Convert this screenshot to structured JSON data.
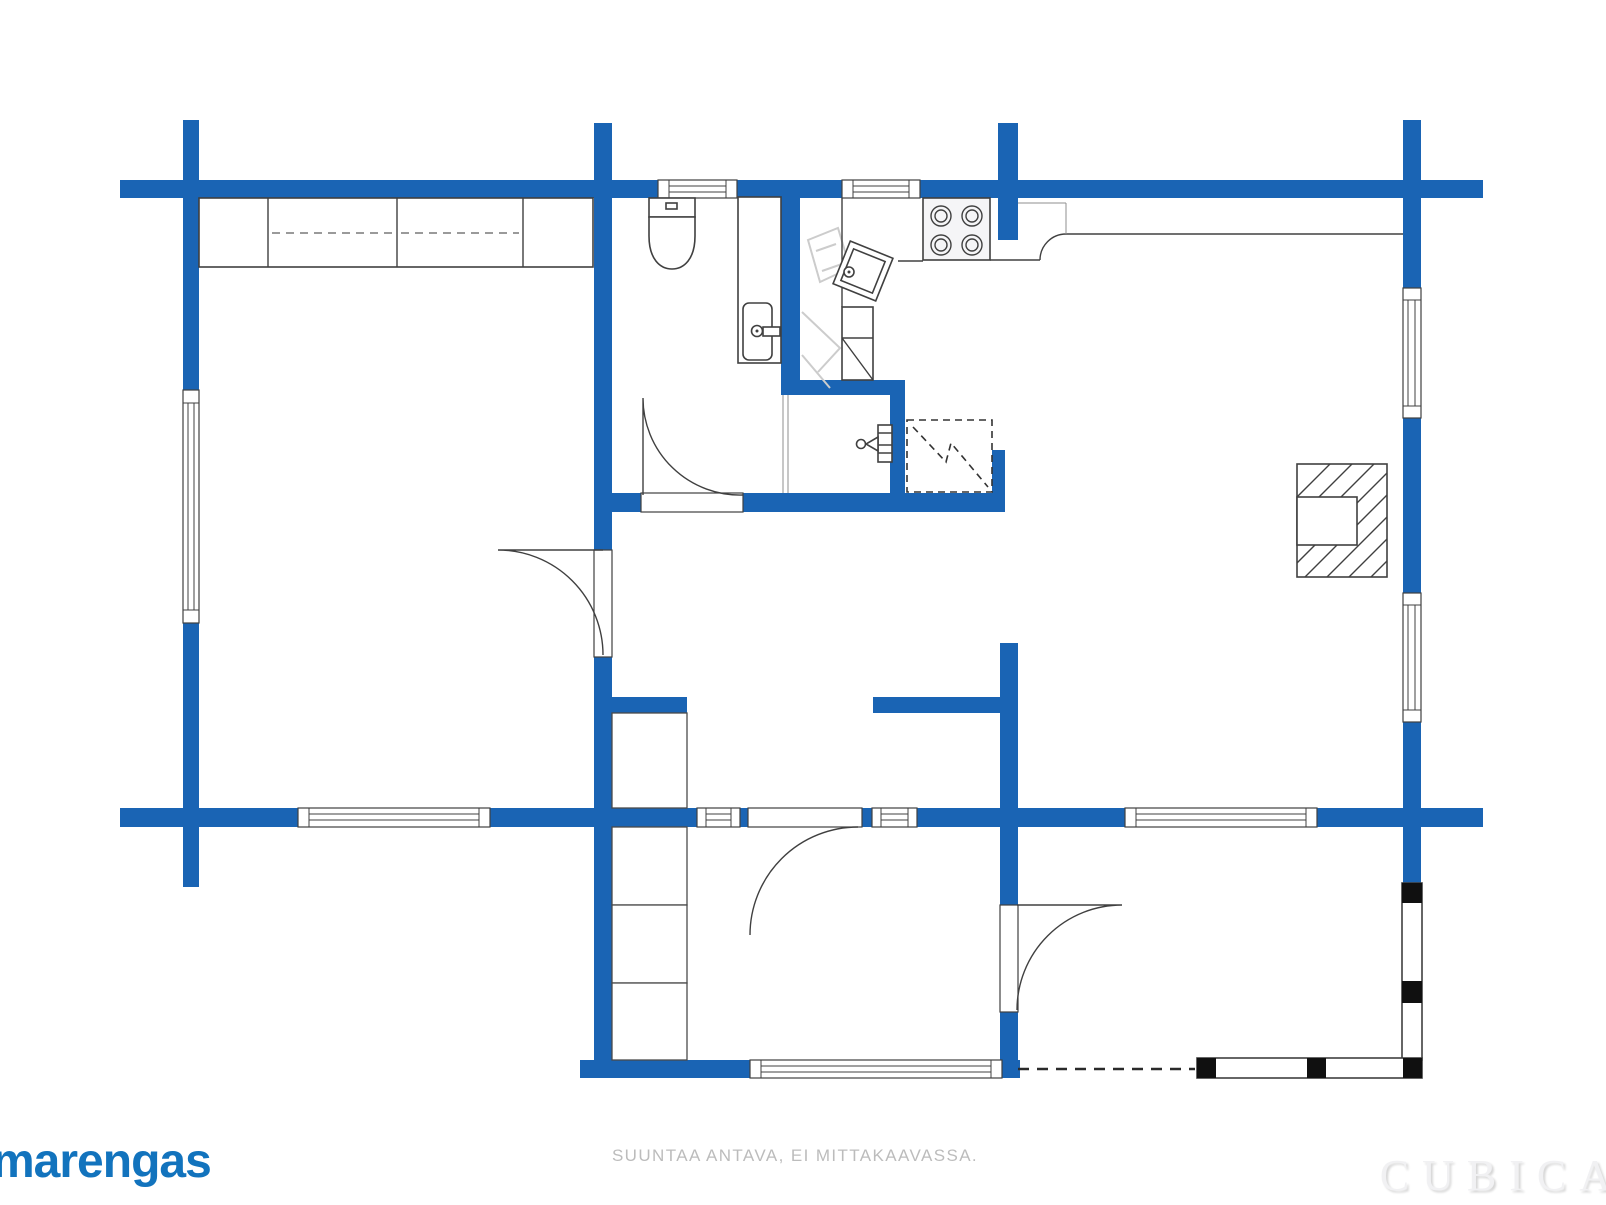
{
  "branding": {
    "logo_text": "marengas"
  },
  "footer": {
    "disclaimer": "SUUNTAA ANTAVA, EI MITTAKAAVASSA.",
    "watermark": "CUBICA"
  },
  "colors": {
    "wall_blue": "#1a64b4",
    "logo_blue": "#1273bd",
    "outline_dark": "#404040",
    "ghost_gray": "#cccccc",
    "disclaimer_gray": "#bcbcbc",
    "watermark_gray": "#f1f1f3",
    "post_black": "#101010",
    "background": "#ffffff"
  },
  "plan": {
    "style": "log-house floor plan, blue walls, no text labels",
    "fixture_symbols": [
      "wardrobe-row-with-hanger-rail",
      "toilet",
      "washbasin-cabinet",
      "corner-sink",
      "stove-4-burner",
      "kitchen-counter",
      "fireplace-hatched",
      "dashed-appliance-reservation",
      "water-tap-valve",
      "hall-closets",
      "door-swing-arcs",
      "windows",
      "terrace-railing-with-posts"
    ]
  }
}
